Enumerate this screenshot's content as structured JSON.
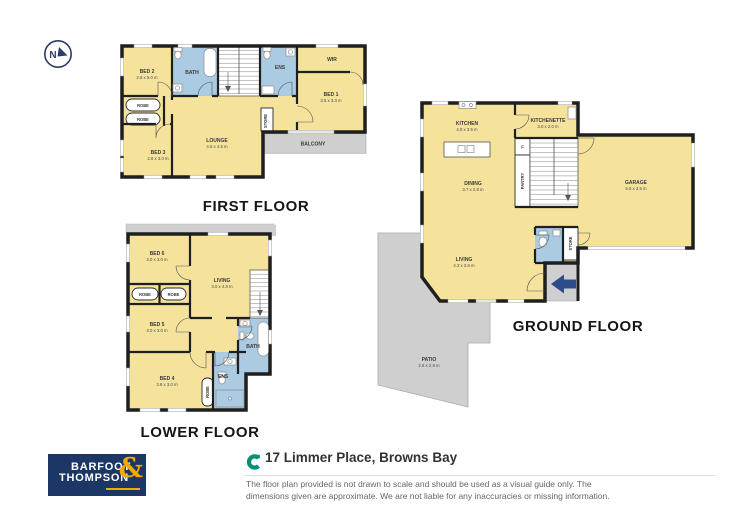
{
  "compass": {
    "north": "N"
  },
  "floors": {
    "first": {
      "title": "FIRST FLOOR",
      "rooms": {
        "bed2": {
          "name": "BED 2",
          "dims": "2.8 x 5.0 m"
        },
        "bath": {
          "name": "BATH"
        },
        "ens": {
          "name": "ENS"
        },
        "wir": {
          "name": "WIR"
        },
        "bed1": {
          "name": "BED 1",
          "dims": "3.5 x 3.3 m"
        },
        "robe_a": {
          "name": "ROBE"
        },
        "robe_b": {
          "name": "ROBE"
        },
        "store": {
          "name": "STORE"
        },
        "lounge": {
          "name": "LOUNGE",
          "dims": "4.5 x 4.5 m"
        },
        "bed3": {
          "name": "BED 3",
          "dims": "2.8 x 3.0 m"
        },
        "balcony": {
          "name": "BALCONY"
        }
      }
    },
    "lower": {
      "title": "LOWER FLOOR",
      "rooms": {
        "bed6": {
          "name": "BED 6",
          "dims": "3.0 x 3.0 m"
        },
        "living": {
          "name": "LIVING",
          "dims": "3.0 x 4.8 m"
        },
        "robe_a": {
          "name": "ROBE"
        },
        "robe_b": {
          "name": "ROBE"
        },
        "bed5": {
          "name": "BED 5",
          "dims": "3.0 x 3.0 m"
        },
        "bath": {
          "name": "BATH"
        },
        "ens": {
          "name": "ENS"
        },
        "bed4": {
          "name": "BED 4",
          "dims": "3.8 x 3.0 m"
        },
        "robe_c": {
          "name": "ROBE"
        }
      }
    },
    "ground": {
      "title": "GROUND FLOOR",
      "rooms": {
        "kitchen": {
          "name": "KITCHEN",
          "dims": "4.5 x 3.5 m"
        },
        "kitchenette": {
          "name": "KITCHENETTE",
          "dims": "3.0 x 2.0 m"
        },
        "dining": {
          "name": "DINING",
          "dims": "3.7 x 2.8 m"
        },
        "fridge": {
          "name": "F"
        },
        "pantry": {
          "name": "PANTRY"
        },
        "garage": {
          "name": "GARAGE",
          "dims": "5.5 x 3.5 m"
        },
        "living": {
          "name": "LIVING",
          "dims": "4.3 x 3.6 m"
        },
        "store": {
          "name": "STORE"
        },
        "patio": {
          "name": "PATIO",
          "dims": "2.8 x 2.8 m"
        }
      }
    }
  },
  "footer": {
    "logo": {
      "line1": "BARFOOT",
      "line2": "THOMPSON",
      "ampersand": "&"
    },
    "address": "17 Limmer Place, Browns Bay",
    "disclaimer_line1": "The floor plan provided is not drawn to scale and should be used as a visual guide only. The",
    "disclaimer_line2": "dimensions given are approximate. We are not liable for any inaccuracies or missing information."
  },
  "colors": {
    "room_fill": "#F5E39B",
    "wet_area_fill": "#ABCBE2",
    "outdoor_fill": "#CFCFCF",
    "wall": "#1F1F1F",
    "logo_navy": "#1C3765",
    "logo_gold": "#F2A900",
    "address_icon_green": "#009174",
    "entry_arrow_navy": "#2C4C8C"
  }
}
